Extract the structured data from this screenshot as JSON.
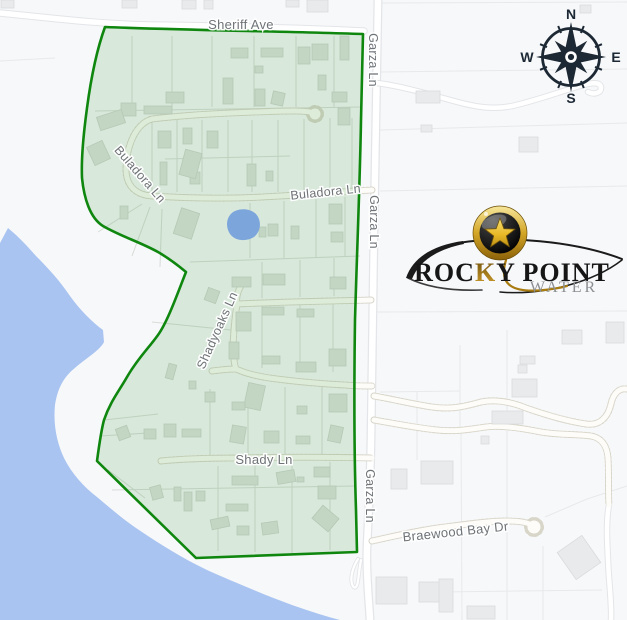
{
  "map": {
    "street_labels": [
      {
        "id": "sheriff-ave",
        "name": "Sheriff Ave"
      },
      {
        "id": "garza-ln-top",
        "name": "Garza Ln"
      },
      {
        "id": "garza-ln-mid",
        "name": "Garza Ln"
      },
      {
        "id": "garza-ln-bottom",
        "name": "Garza Ln"
      },
      {
        "id": "buladora-ln-left",
        "name": "Buladora Ln"
      },
      {
        "id": "buladora-ln-right",
        "name": "Buladora Ln"
      },
      {
        "id": "shadyoaks-ln",
        "name": "Shadyoaks Ln"
      },
      {
        "id": "shady-ln",
        "name": "Shady Ln"
      },
      {
        "id": "braewood-bay-dr",
        "name": "Braewood Bay Dr"
      }
    ],
    "colors": {
      "background": "#f7f8fa",
      "water": "#a9c4f1",
      "pond": "#7ca6db",
      "service_area_fill": "rgba(76,160,76,0.18)",
      "service_area_border": "#0f870f",
      "road_fill": "#ffffff",
      "road_casing": "#e3e5e8",
      "unpaved_dots": "#d8d5c9",
      "street_label": "#6e7377",
      "building_fill": "#e9eaec",
      "building_inside_fill": "#dde1dd",
      "parcel_line": "#e7e9eb",
      "compass": "#1c2834",
      "logo_gold": "#c0922a",
      "logo_black": "#161616",
      "logo_gray": "#8d9093"
    }
  },
  "compass": {
    "north": "N",
    "east": "E",
    "south": "S",
    "west": "W"
  },
  "logo": {
    "rocky": "ROC",
    "gold_k": "K",
    "point": "Y POINT",
    "water": "WATER"
  }
}
